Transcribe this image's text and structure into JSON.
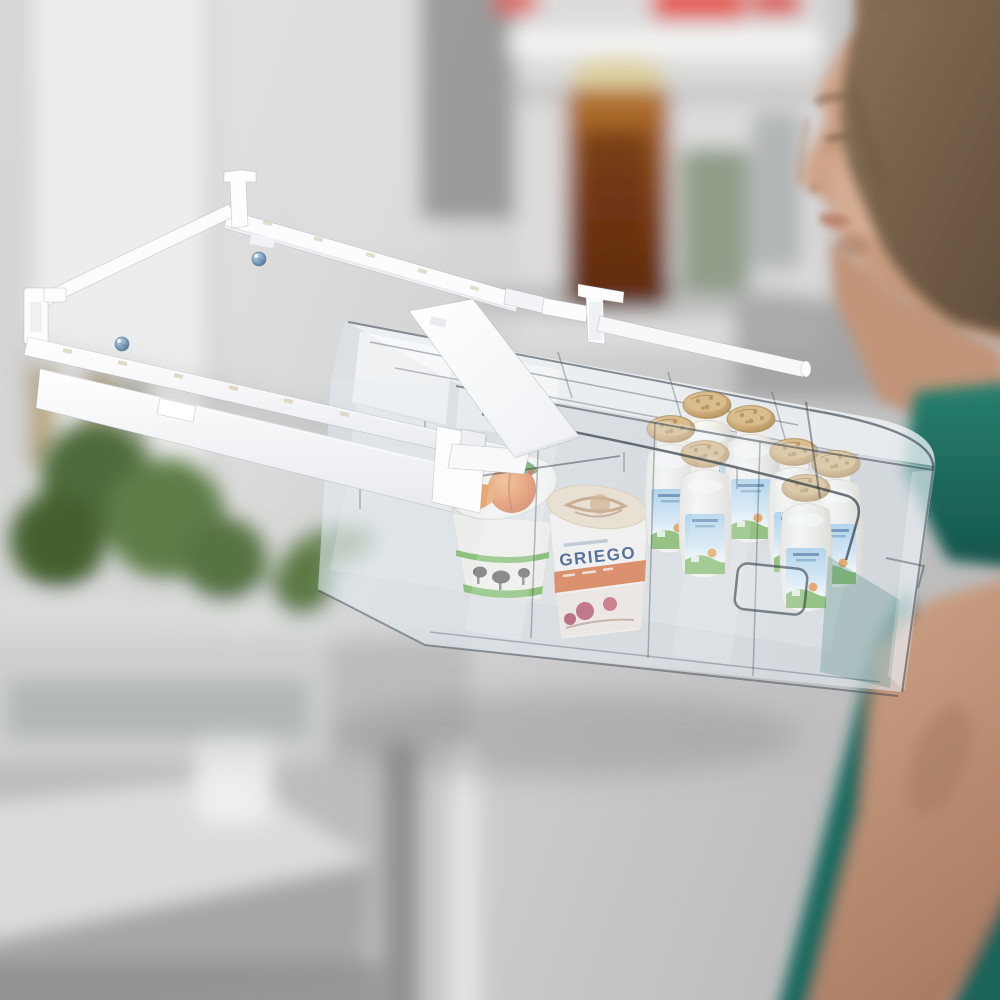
{
  "photo": {
    "kind": "product photograph",
    "subject": "Pull-out under-shelf refrigerator storage drawer organizer",
    "scene": "Open refrigerator interior, blurred; woman in teal top looking into fridge"
  },
  "visible_text": [
    "GRIEGO"
  ],
  "griego_cup": {
    "brand": "GRIEGO",
    "brand_color": "#1c3f74",
    "banner_color": "#d96a35"
  },
  "organizer": {
    "frame_color": "#fbfbfd",
    "shelf_hooks": 4,
    "adjustment_screws": 2,
    "screw_color": "#6f94b5",
    "drawer": {
      "transparent": true,
      "columns": 4,
      "rows": 3,
      "has_handle": true
    }
  },
  "contents": {
    "yogurt_drink_bottles": 7,
    "foil_cap_color": "#c9a873",
    "label_sky_color": "#9ecbe9",
    "label_green": "#6fae4e",
    "label_orange": "#e8903f",
    "peach_cup": {
      "lid_art": "peach-with-leaves",
      "peach_color": "#e0732f",
      "stripe_color": "#5aa93a",
      "pattern": "cows"
    }
  },
  "background": {
    "red_lids": 3,
    "jam_jar_color": "#8a4a1b",
    "jam_lid_color": "#ded2a2",
    "herb_color": "#4e6b3a",
    "woman_top_color": "#1d6a5f",
    "woman_skin_color": "#c79e85",
    "woman_hair_color": "#7b6450"
  }
}
